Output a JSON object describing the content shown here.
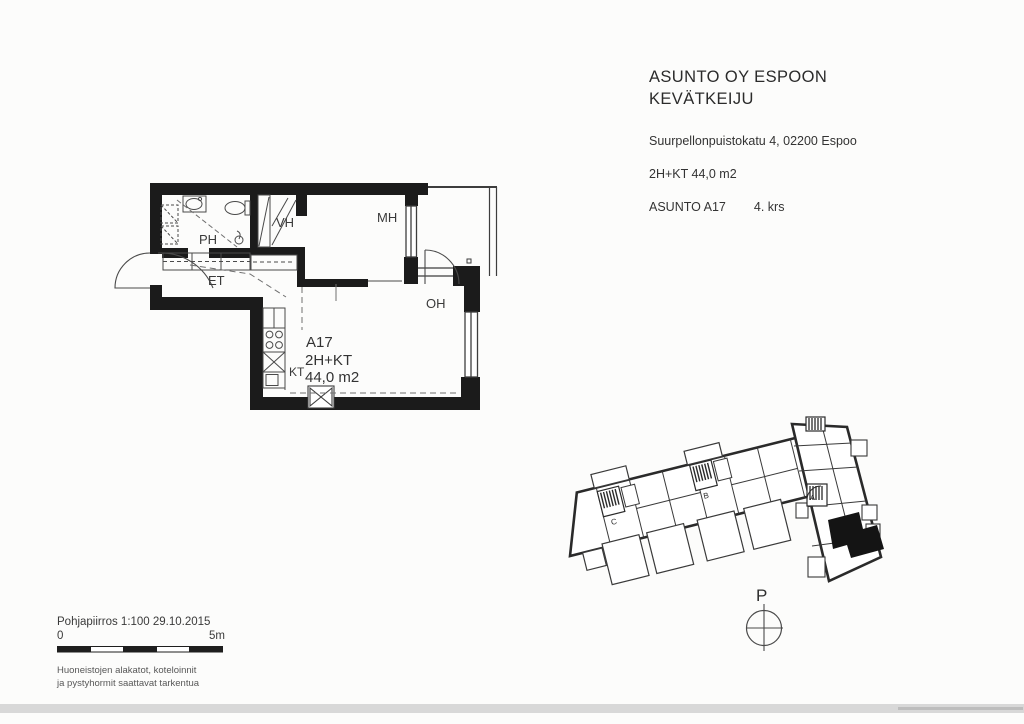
{
  "header": {
    "company_line1": "ASUNTO OY ESPOON",
    "company_line2": "KEVÄTKEIJU",
    "address": "Suurpellonpuistokatu 4, 02200 Espoo",
    "apartment_type": "2H+KT 44,0 m2",
    "apartment_label": "ASUNTO A17",
    "apartment_floor": "4. krs"
  },
  "floor_plan": {
    "labels": {
      "ph": "PH",
      "vh": "VH",
      "mh": "MH",
      "et": "ET",
      "oh": "OH",
      "kt": "KT"
    },
    "apartment": {
      "id": "A17",
      "type": "2H+KT",
      "area": "44,0 m2"
    }
  },
  "site_plan": {
    "stairs": {
      "a": "A",
      "b": "B",
      "c": "C"
    },
    "north": "P"
  },
  "footer": {
    "drawing_title": "Pohjapiirros 1:100 29.10.2015",
    "scale_zero": "0",
    "scale_five": "5m",
    "note_line1": "Huoneistojen alakatot, koteloinnit",
    "note_line2": "ja pystyhormit saattavat tarkentua"
  },
  "colors": {
    "wall": "#1b1b1b",
    "thin_line": "#4a4a4a",
    "dashed_line": "#6f6f6f",
    "text": "#2e2e2e",
    "note_text": "#585858",
    "scan_band": "#d8d8d8"
  }
}
